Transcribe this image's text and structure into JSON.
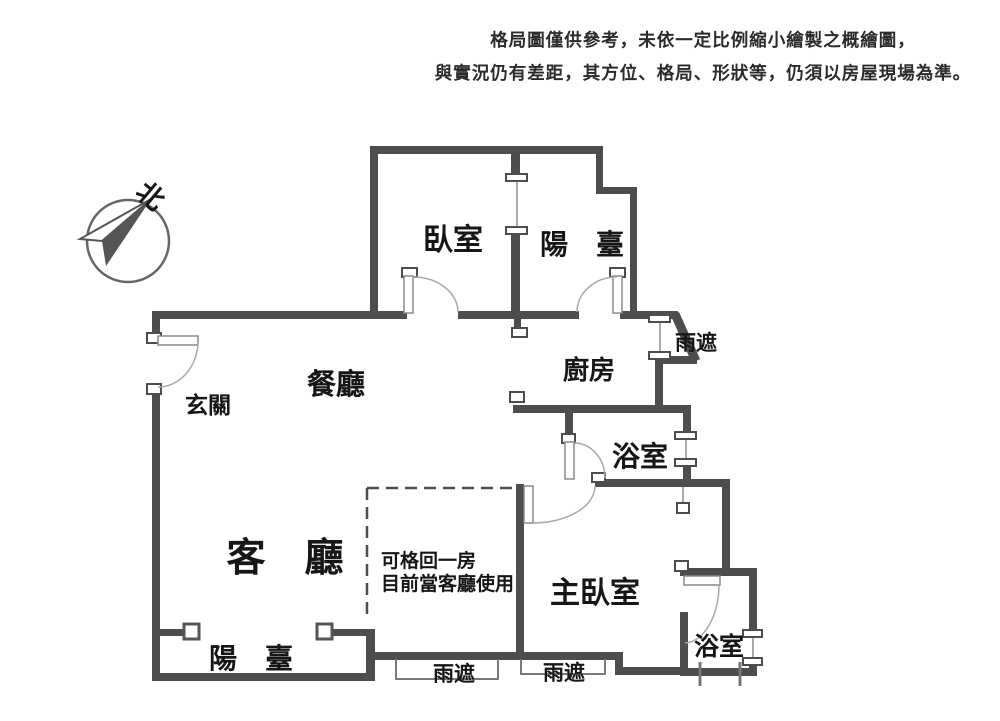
{
  "disclaimer": {
    "line1": "格局圖僅供參考，未依一定比例縮小繪製之概繪圖，",
    "line2": "與實況仍有差距，其方位、格局、形狀等，仍須以房屋現場為準。"
  },
  "compass": {
    "north_label": "北"
  },
  "rooms": {
    "bedroom": "臥室",
    "balcony_top": "陽　臺",
    "rain_cover_right": "雨遮",
    "kitchen": "廚房",
    "dining": "餐廳",
    "entry": "玄關",
    "bath_upper": "浴室",
    "living": "客　廳",
    "flex_note_line1": "可格回一房",
    "flex_note_line2": "目前當客廳使用",
    "master_bedroom": "主臥室",
    "balcony_bottom": "陽　臺",
    "rain_cover_bottom_left": "雨遮",
    "rain_cover_bottom_right": "雨遮",
    "bath_lower": "浴室"
  },
  "colors": {
    "wall": "#4d4d4d",
    "thin": "#8f8f8f",
    "ink": "#161616",
    "bg": "#ffffff",
    "arc": "#a9a9a9"
  }
}
